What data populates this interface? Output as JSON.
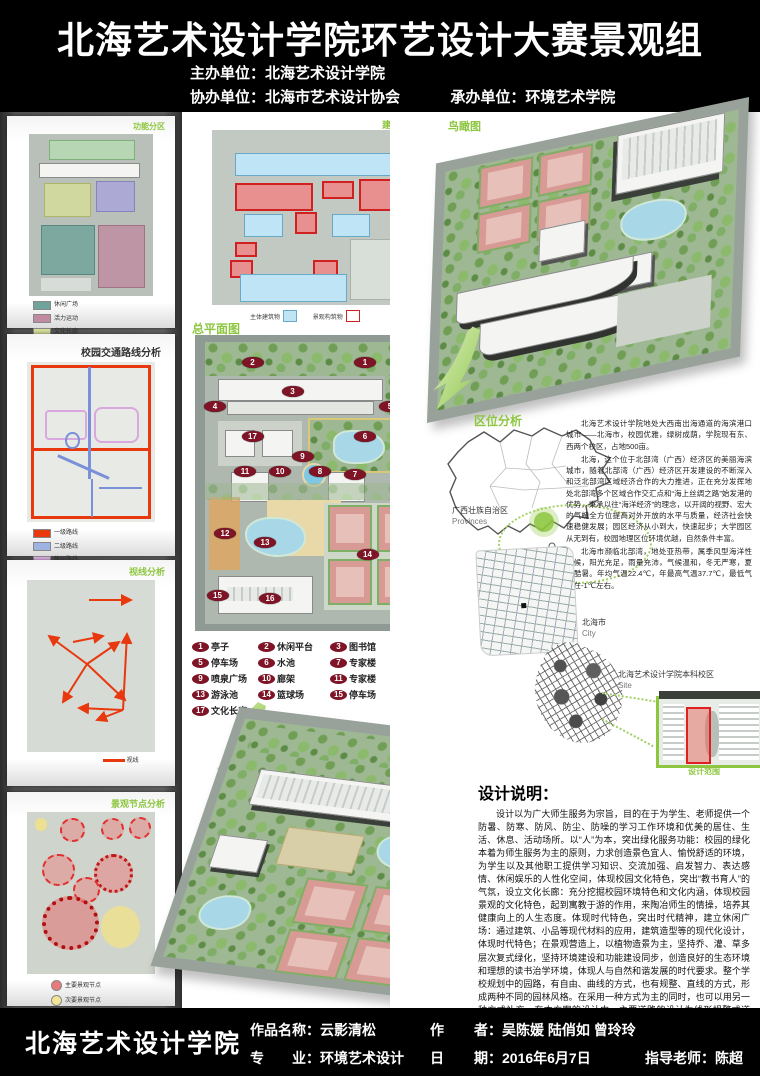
{
  "header": {
    "title": "北海艺术设计学院环艺设计大赛景观组",
    "line1": "主办单位：北海艺术设计学院",
    "line2": "协办单位：北海市艺术设计协会",
    "line3": "承办单位：环境艺术学院"
  },
  "left_panels": [
    {
      "title": "功能分区",
      "legend": [
        {
          "color": "#6fa39b",
          "label": "休闲广场"
        },
        {
          "color": "#c08ba0",
          "label": "活力运动"
        },
        {
          "color": "#d6dd99",
          "label": "文化长廊"
        },
        {
          "color": "#a9a6dc",
          "label": "教学一区"
        },
        {
          "color": "#b7dcb2",
          "label": "绿荫广场"
        }
      ]
    },
    {
      "title": "校园交通路线分析",
      "legend": [
        {
          "color": "#e8380d",
          "label": "一级路线"
        },
        {
          "color": "#9fb3e3",
          "label": "二级路线"
        },
        {
          "color": "#e3b5e8",
          "label": "休闲路线"
        },
        {
          "color": "#33514d",
          "label": "绿地路线"
        }
      ]
    },
    {
      "title": "视线分析",
      "legend": [
        {
          "color": "#e8380d",
          "label": "视线"
        }
      ]
    },
    {
      "title": "景观节点分析",
      "legend": [
        {
          "color": "#e87a7a",
          "label": "主要景观节点"
        },
        {
          "color": "#f2e598",
          "label": "次要景观节点"
        }
      ]
    }
  ],
  "middle": {
    "texture_title": "建筑及构筑物分析",
    "texture_legend": [
      {
        "color": "#bfe4f5",
        "label": "主体建筑物"
      },
      {
        "color": "#ffffff",
        "label": "景观构筑物"
      }
    ],
    "master_plan_title": "总平面图",
    "aerial_label": "鸟瞰图"
  },
  "master_legend": [
    {
      "num": "1",
      "label": "亭子"
    },
    {
      "num": "2",
      "label": "休闲平台"
    },
    {
      "num": "3",
      "label": "图书馆"
    },
    {
      "num": "4",
      "label": "停车场"
    },
    {
      "num": "5",
      "label": "停车场"
    },
    {
      "num": "6",
      "label": "水池"
    },
    {
      "num": "7",
      "label": "专家楼"
    },
    {
      "num": "8",
      "label": "廊架"
    },
    {
      "num": "9",
      "label": "喷泉广场"
    },
    {
      "num": "10",
      "label": "廊架"
    },
    {
      "num": "11",
      "label": "专家楼"
    },
    {
      "num": "12",
      "label": "花園"
    },
    {
      "num": "13",
      "label": "游泳池"
    },
    {
      "num": "14",
      "label": "篮球场"
    },
    {
      "num": "15",
      "label": "停车场"
    },
    {
      "num": "16",
      "label": "食堂"
    },
    {
      "num": "17",
      "label": "文化长廊"
    }
  ],
  "markers": [
    {
      "n": "1",
      "x": 68,
      "y": 9
    },
    {
      "n": "2",
      "x": 23,
      "y": 9
    },
    {
      "n": "3",
      "x": 39,
      "y": 19
    },
    {
      "n": "4",
      "x": 8,
      "y": 24
    },
    {
      "n": "5",
      "x": 78,
      "y": 24
    },
    {
      "n": "6",
      "x": 68,
      "y": 34
    },
    {
      "n": "7",
      "x": 64,
      "y": 47
    },
    {
      "n": "8",
      "x": 50,
      "y": 46
    },
    {
      "n": "9",
      "x": 43,
      "y": 41
    },
    {
      "n": "10",
      "x": 34,
      "y": 46
    },
    {
      "n": "11",
      "x": 20,
      "y": 46
    },
    {
      "n": "12",
      "x": 12,
      "y": 67
    },
    {
      "n": "13",
      "x": 28,
      "y": 70
    },
    {
      "n": "14",
      "x": 69,
      "y": 74
    },
    {
      "n": "15",
      "x": 9,
      "y": 88
    },
    {
      "n": "16",
      "x": 30,
      "y": 89
    },
    {
      "n": "17",
      "x": 23,
      "y": 34
    }
  ],
  "right": {
    "aerial_label": "鸟瞰图",
    "location_title": "区位分析",
    "province_label": "广西壮族自治区",
    "province_sub": "Provinces",
    "city_label": "北海市",
    "city_sub": "City",
    "site_label": "北海艺术设计学院本科校区",
    "site_sub": "Site",
    "scope_label": "设计范围",
    "loc_p1": "北海艺术设计学院地处大西南出海通道的海滨港口城市——北海市，校园优雅，绿树成荫，学院现有东、西两个校区，占地500亩。",
    "loc_p2": "北海，这个位于北部湾（广西）经济区的美丽海滨城市，随着北部湾（广西）经济区开发建设的不断深入和泛北部湾区域经济合作的大力推进，正在充分发挥地处北部湾多个区域合作交汇点和“海上丝绸之路”始发港的优势，秉承以往“海洋经济”的理念，以开阔的视野、宏大的气魄全方位提高对外开放的水平与质量，经济社会快速稳健发展；园区经济从小到大，快速起步；大学园区从无到有，校园地理区位环境优越，自然条件丰富。",
    "loc_p3": "北海市濒临北部湾，地处亚热带，属季风型海洋性气候，阳光充足，雨量充沛，气候温和，冬无严寒，夏无酷暑。年均气温22.4℃，年最高气温37.7℃，最低气温在-1℃左右。",
    "description_title": "设计说明：",
    "description_text": "设计以为广大师生服务为宗旨，目的在于为学生、老师提供一个防暑、防寒、防风、防尘、防噪的学习工作环境和优美的居住、生活、休息、活动场所。以“人”为本，突出绿化服务功能：校园的绿化本着为师生服务为主的原则，力求创造景色宜人、愉悦舒适的环境，为学生以及其他职工提供学习知识、交流加强、启发智力、表达感情、休闲娱乐的人性化空间，体现校园文化特色，突出“教书育人”的气氛，设立文化长廊：充分挖掘校园环境特色和文化内涵，体现校园景观的文化特色，起到寓教于游的作用，来陶冶师生的情操，培养其健康向上的人生态度。体现时代特色，突出时代精神，建立休闲广场：通过建筑、小品等现代材料的应用，建筑造型等的现代化设计，体现时代特色；在景观营造上，以植物造景为主，坚持乔、灌、草多层次复式绿化，坚持环境建设和功能建设同步，创造良好的生态环境和理想的读书治学环境，体现人与自然和谐发展的时代要求。整个学校规划中的园路，有自由、曲线的方式，也有规整、直线的方式，形成两种不同的园林风格。在采用一种方式为主的同时，也可以用另一种方式补充。在本方案的设计中，主要道路的设计为线形规整式道路，而所有园路均采用了自然式，园路的线型设计以方便游人游览整个游区为主，同时也满足学生们晨读和休息时的使用。道路绿化以遮荫为主，行道树主要选用榕树、槐树等。"
  },
  "footer": {
    "school": "北海艺术设计学院",
    "work_line": "作品名称：云影清松",
    "major_line": "专　　业：环境艺术设计",
    "author_label": "作",
    "author_line": "者：吴陈媛 陆俏如 曾玲玲",
    "date_label": "日",
    "date_line": "期：2016年6月7日",
    "advisor_line": "指导老师：陈超"
  },
  "colors": {
    "accent_green": "#8dc63f",
    "marker_red": "#7e1425",
    "route_red": "#e8380d",
    "header_bg": "#000000"
  }
}
